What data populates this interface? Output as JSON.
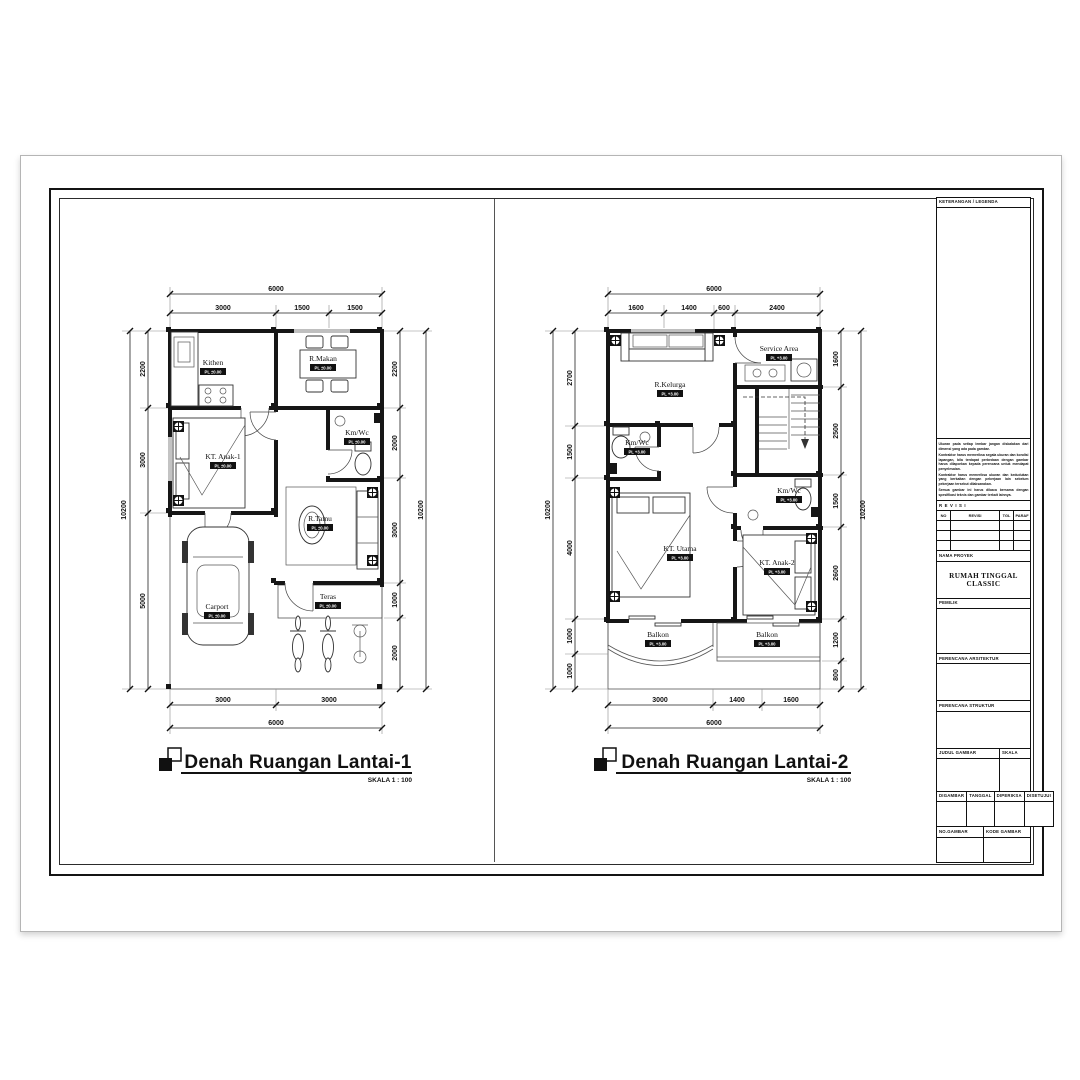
{
  "sheet": {
    "legend_title": "KETERANGAN / LEGENDA",
    "notes": [
      "Ukuran pada setiap lembar jangan diskalakan dari dimensi yang ada pada gambar.",
      "Kontraktor harus memeriksa segala ukuran dan kondisi lapangan, bila terdapat perbedaan dengan gambar harus dilaporkan kepada perencana untuk mendapat penyelesaian.",
      "Kontraktor harus memeriksa ukuran dan kedudukan yang berkaitan dengan pekerjaan lain sebelum pekerjaan tersebut dilaksanakan.",
      "Semua gambar ini harus dibaca bersama dengan spesifikasi teknis dan gambar terkait lainnya."
    ],
    "revisi_header": "REVISI",
    "revisi_columns": [
      "NO",
      "REVISI",
      "TGL",
      "PARAF"
    ],
    "nama_proyek_label": "NAMA PROYEK",
    "project_name": "RUMAH TINGGAL CLASSIC",
    "pemilik_label": "PEMILIK",
    "perencana_arsitektur_label": "PERENCANA ARSITEKTUR",
    "perencana_struktur_label": "PERENCANA STRUKTUR",
    "judul_gambar_label": "JUDUL GAMBAR",
    "skala_label": "SKALA",
    "digambar_label": "DIGAMBAR",
    "tanggal_label": "TANGGAL",
    "diperiksa_label": "DIPERIKSA",
    "disetujui_label": "DISETUJUI",
    "no_gambar_label": "NO.GAMBAR",
    "kode_gambar_label": "KODE GAMBAR"
  },
  "plan1": {
    "title": "Denah Ruangan Lantai-1",
    "scale_label": "SKALA 1 : 100",
    "total_width": "6000",
    "total_height": "10200",
    "top_segments": [
      "3000",
      "1500",
      "1500"
    ],
    "left_segments": [
      "2200",
      "3000",
      "5000"
    ],
    "right_segments": [
      "2200",
      "2000",
      "3000",
      "1000",
      "2000"
    ],
    "bottom_segments": [
      "3000",
      "3000"
    ],
    "rooms": {
      "kitchen": {
        "name": "Kithen",
        "level": "PL ±0.00"
      },
      "dining": {
        "name": "R.Makan",
        "level": "PL ±0.00"
      },
      "bedroom1": {
        "name": "KT. Anak-1",
        "level": "PL ±0.00"
      },
      "bathroom": {
        "name": "Km/Wc",
        "level": "PL ±0.00"
      },
      "living": {
        "name": "R.Tamu",
        "level": "PL ±0.00"
      },
      "terrace": {
        "name": "Teras",
        "level": "PL ±0.00"
      },
      "carport": {
        "name": "Carport",
        "level": "PL ±0.00"
      }
    }
  },
  "plan2": {
    "title": "Denah Ruangan Lantai-2",
    "scale_label": "SKALA 1 : 100",
    "total_width": "6000",
    "total_height": "10200",
    "top_segments": [
      "1600",
      "1400",
      "600",
      "2400"
    ],
    "left_segments": [
      "2700",
      "1500",
      "4000",
      "1000",
      "1000"
    ],
    "right_segments": [
      "1600",
      "2500",
      "1500",
      "2600",
      "1200",
      "800"
    ],
    "bottom_segments": [
      "3000",
      "1400",
      "1600"
    ],
    "rooms": {
      "family": {
        "name": "R.Kelurga",
        "level": "PL +3.00"
      },
      "service": {
        "name": "Service Area",
        "level": "PL +3.00"
      },
      "bath_left": {
        "name": "Km/Wc",
        "level": "PL +3.00"
      },
      "master": {
        "name": "KT. Utama",
        "level": "PL +3.00"
      },
      "bath_right": {
        "name": "Km/Wc",
        "level": "PL +3.00"
      },
      "bedroom2": {
        "name": "KT. Anak-2",
        "level": "PL +3.00"
      },
      "balcony_left": {
        "name": "Balkon",
        "level": "PL +3.00"
      },
      "balcony_right": {
        "name": "Balkon",
        "level": "PL +3.00"
      }
    }
  }
}
